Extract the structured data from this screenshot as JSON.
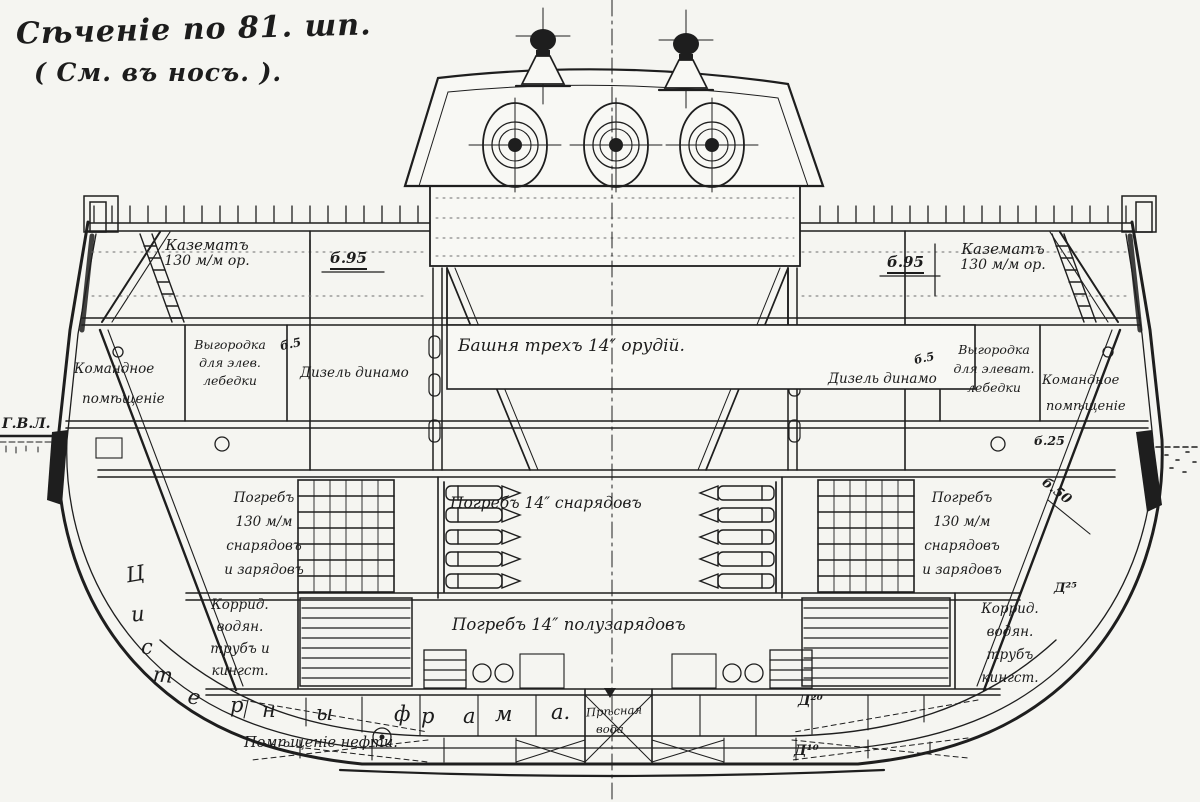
{
  "drawing": {
    "title_line1": "Сѣченіе по 81. шп.",
    "title_line2": "( См. въ носъ. ).",
    "waterline_label": "Г.В.Л.",
    "ink_color": "#1e1e1e",
    "paper_color": "#f5f5f1"
  },
  "upper_deck": {
    "casemate_left_line1": "Казематъ",
    "casemate_left_line2": "130 м/м ор.",
    "thickness_b95_left": "б.95",
    "thickness_b95_right": "б.95",
    "casemate_right_line1": "Казематъ",
    "casemate_right_line2": "130 м/м ор."
  },
  "turret": {
    "label": "Башня трехъ 14″ орудій."
  },
  "middle_deck": {
    "command_room_left_line1": "Командное",
    "command_room_left_line2": "помѣщеніе",
    "winch_enclosure_left_line1": "Выгородка",
    "winch_enclosure_left_line2": "для элев.",
    "winch_enclosure_left_line3": "лебедки",
    "thickness_b5_left": "б.5",
    "diesel_dynamo_left": "Дизель динамо",
    "diesel_dynamo_right": "Дизель динамо",
    "thickness_b5_right": "б.5",
    "winch_enclosure_right_line1": "Выгородка",
    "winch_enclosure_right_line2": "для элеват.",
    "winch_enclosure_right_line3": "лебедки",
    "command_room_right_line1": "Командное",
    "command_room_right_line2": "помѣщеніе",
    "thickness_b25_right": "б.25",
    "thickness_b50_right": "б.50"
  },
  "magazines": {
    "left_line1": "Погребъ",
    "left_line2": "130 м/м",
    "left_line3": "снарядовъ",
    "left_line4": "и зарядовъ",
    "shells_14in": "Погребъ 14″ снарядовъ",
    "right_line1": "Погребъ",
    "right_line2": "130 м/м",
    "right_line3": "снарядовъ",
    "right_line4": "и зарядовъ",
    "half_charges_14in": "Погребъ 14″ полузарядовъ",
    "thickness_d25_right": "Д²⁵"
  },
  "hold": {
    "corridor_left_line1": "Коррид.",
    "corridor_left_line2": "водян.",
    "corridor_left_line3": "трубъ и",
    "corridor_left_line4": "кингст.",
    "corridor_right_line1": "Коррид.",
    "corridor_right_line2": "водян.",
    "corridor_right_line3": "трубъ",
    "corridor_right_line4": "кингст."
  },
  "bottom": {
    "frahm_tanks_letters": [
      "Ц",
      "и",
      "с",
      "т",
      "е",
      "р",
      "н",
      "ы",
      "ф",
      "р",
      "а",
      "м",
      "а."
    ],
    "oil_compartment": "Помѣщеніе нефти.",
    "fresh_water_line1": "Прѣсная",
    "fresh_water_line2": "вода",
    "thickness_d20": "Д²⁰",
    "thickness_d10": "Д¹⁰"
  }
}
